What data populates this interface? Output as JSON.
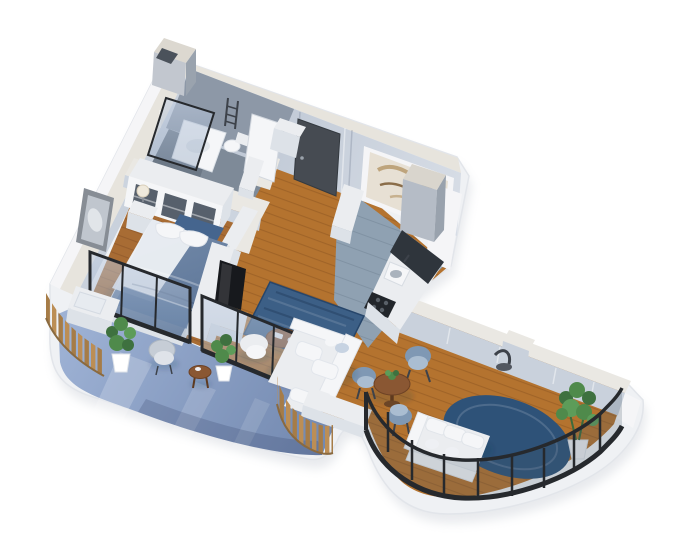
{
  "scene": {
    "type": "isometric-3d-apartment-floor-plan-render",
    "rooms": [
      "bathroom",
      "entry-hall",
      "kitchen",
      "bedroom",
      "living-room",
      "dining-area",
      "left-balcony",
      "curved-terrace"
    ],
    "objects": [
      "shower-enclosure",
      "toilet",
      "vanity",
      "towel-ladder",
      "bathroom-door",
      "entry-door",
      "art-window",
      "wardrobe-cubbies",
      "nightstand",
      "table-lamp",
      "double-bed",
      "leaning-picture-frame",
      "tv-partition-wall",
      "tv",
      "media-console",
      "blue-area-rug",
      "coffee-table",
      "l-shaped-sofa",
      "armchair",
      "kitchen-counter",
      "sink",
      "cooktop",
      "round-dining-table",
      "blue-tub-chairs",
      "terrace-sofa",
      "round-navy-rug",
      "potted-plants",
      "rattan-chair",
      "side-table",
      "storage-bench",
      "wood-slat-screens",
      "black-glass-railing",
      "rooftop-duct-boxes"
    ]
  },
  "colors": {
    "slab": "#eff1f4",
    "slabEdge": "#e2e5ea",
    "slabShadow": "#ccd0d8",
    "wallOuter": "#f5f5f7",
    "wallTop": "#e7e4dd",
    "wallFace": "#c9d1dc",
    "northA": "#b7c1cf",
    "northB": "#d7dde6",
    "bathWall": "#8d98a7",
    "partTop": "#eae8e3",
    "partFace": "#ccd4df",
    "doorDark": "#464b52",
    "artBg": "#e7e0d4",
    "art1": "#b99d72",
    "art2": "#8a6d49",
    "wood": "#b4732f",
    "woodLine": "#8f5722",
    "kitchenFloor": "#8fa1b2",
    "bathFloor": "#7e8a98",
    "showerFloor": "#6a7584",
    "balcA": "#9db1d4",
    "balcB": "#7187ae",
    "rug": "#3c5f86",
    "rugEdge": "#27466b",
    "rugDeep": "#2e5278",
    "bench": "#45658e",
    "duvetA": "#7289a8",
    "duvetB": "#5a7396",
    "blanket": "#4e6d96",
    "sheet": "#edf0f4",
    "white": "#ebedf0",
    "whiteSoft": "#f5f6f8",
    "whiteDim": "#dde2e8",
    "glassA": "#c3d0e4",
    "glassB": "#8fa3bd",
    "frame": "#26292d",
    "slatA": "#bc8e55",
    "slatB": "#a67c47",
    "tableWood": "#8a5733",
    "tableEdge": "#6d4225",
    "chairA": "#7f98b4",
    "chairB": "#aabdd1",
    "plantA": "#3e713f",
    "plantB": "#4f8a4b",
    "plantC": "#5d9c59",
    "tv": "#17191d",
    "counterDark": "#2f353c",
    "stove": "#22262b",
    "metal": "#3d424a",
    "shadow": "rgba(30,40,60,0.13)"
  }
}
